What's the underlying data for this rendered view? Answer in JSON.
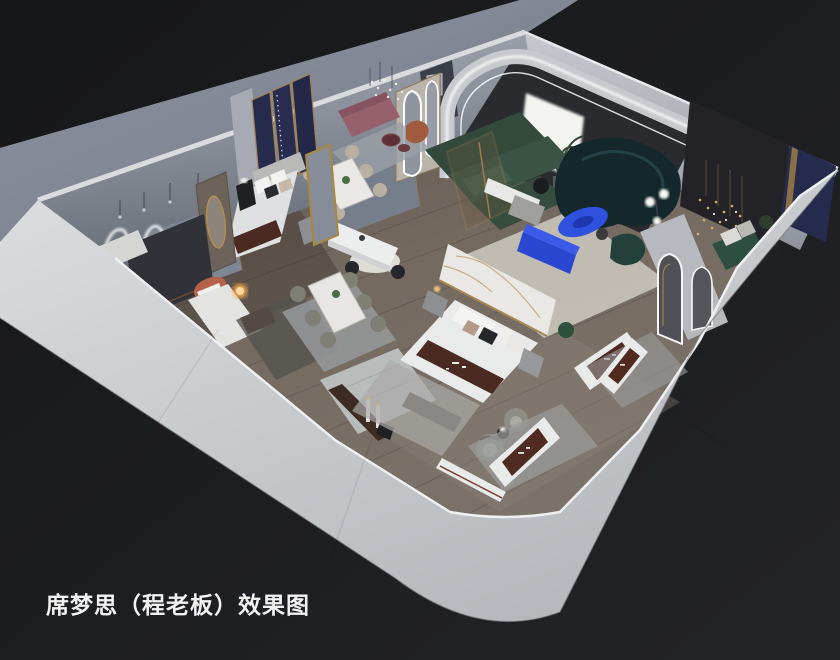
{
  "caption": {
    "text": "席梦思（程老板）效果图"
  },
  "scene": {
    "description": "3D isometric cutaway rendering of a mattress showroom interior viewed from above",
    "palette": {
      "background_dark": "#1a1b1e",
      "outer_wall_light": "#cdd0d3",
      "backdrop_gray": "#878d99",
      "interior_wall": "#9aa0ac",
      "floor_wood": "#6e655c",
      "sofa_teal": "#14282b",
      "accent_cobalt": "#2e52de",
      "sofa_green": "#3b5344",
      "mattress_brown": "#4b2a21",
      "mattress_white": "#e9eaea",
      "gold_trim": "#a8884f",
      "navy_panel": "#262b4d",
      "lamp_orange": "#ffab4f",
      "terracotta": "#b4624a",
      "pink_bench": "#96616c",
      "caption_white": "#f2f2f2"
    },
    "objects": [
      "curved teal sofa",
      "cobalt oval coffee table",
      "cobalt media bench",
      "green sectional sofa",
      "arched LED wall",
      "backlit white panel",
      "dining table with six chairs",
      "dining table set on rug",
      "round dining table",
      "white island counter",
      "upholstered bed with navy gold screens",
      "terracotta bed with glowing sphere lamp",
      "marble headboard wall",
      "display bed with brown brand runner",
      "mattress displays with brand runners",
      "swivel barrel chairs",
      "arched mirrors",
      "capsule mirrors",
      "gold bead chandeliers",
      "neon squiggle wall light",
      "pink bench lounge",
      "floor plants",
      "floor lamps",
      "bedside nightstands"
    ]
  }
}
